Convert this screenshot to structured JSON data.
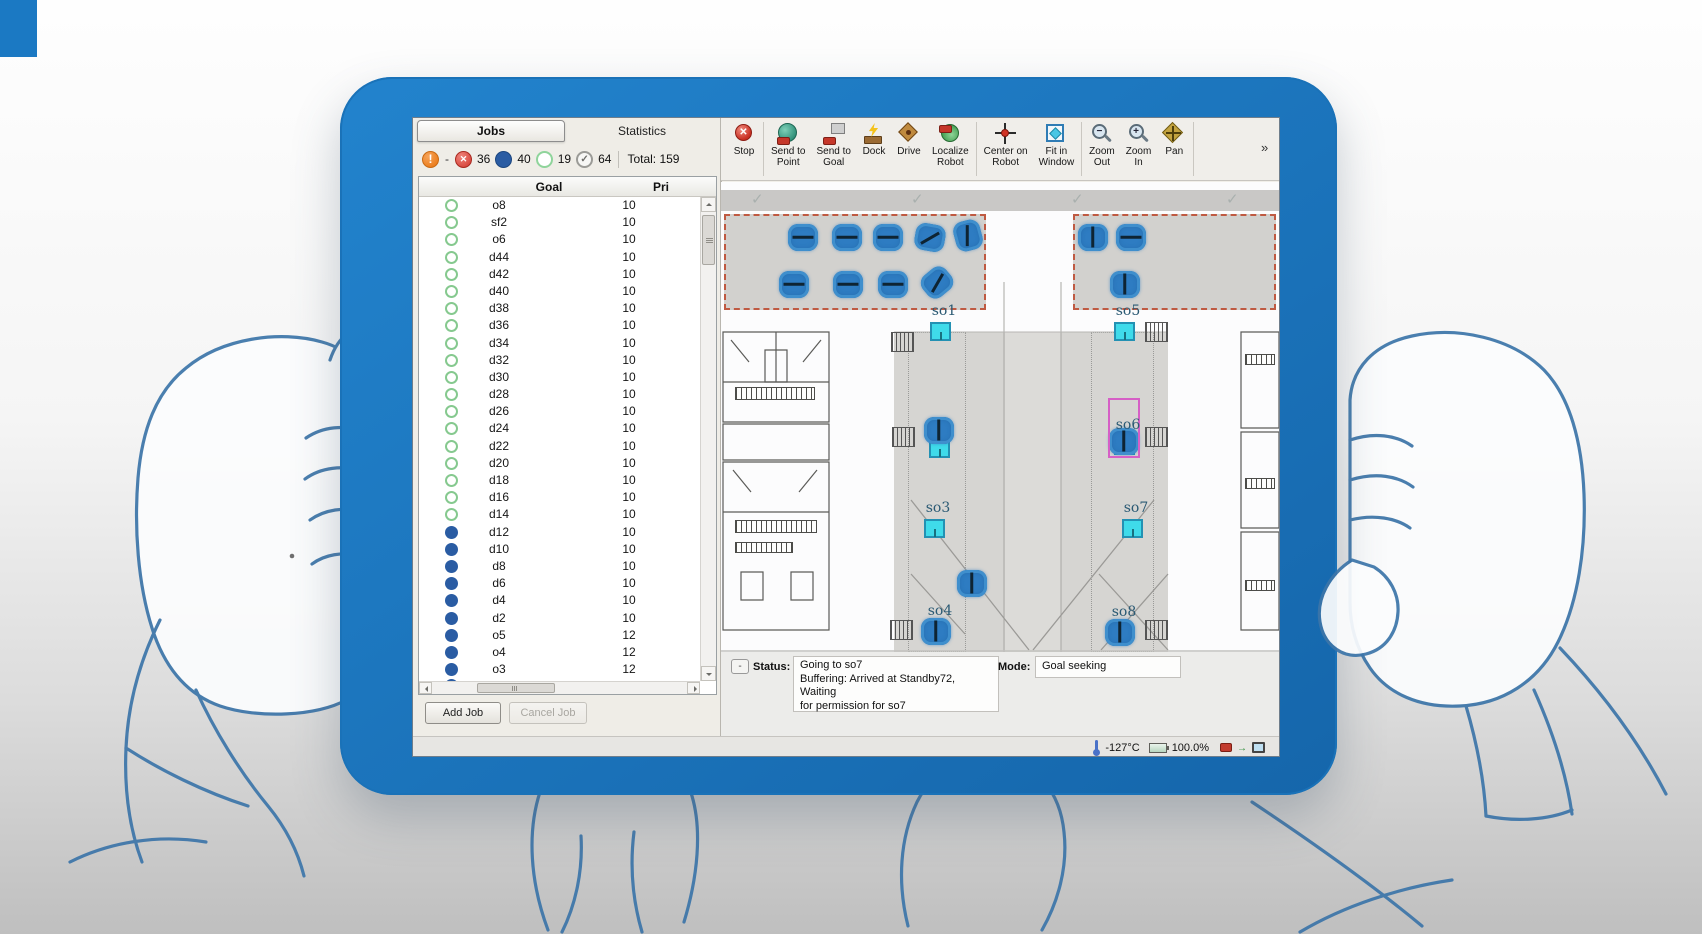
{
  "jobs_panel": {
    "tabs": {
      "jobs": "Jobs",
      "statistics": "Statistics"
    },
    "counters": {
      "overflow_dash": "-",
      "failed": "36",
      "in_progress": "40",
      "queued": "19",
      "completed": "64",
      "total": "Total: 159",
      "colors": {
        "failed": "#d84a40",
        "in_progress": "#2a5ca3",
        "queued": "#8fd49b",
        "completed": "#9b9b97",
        "warning": "#ec7f1f"
      }
    },
    "table": {
      "columns": {
        "goal": "Goal",
        "priority": "Pri"
      },
      "rows": [
        {
          "goal": "o8",
          "pri": "10",
          "state": "queued"
        },
        {
          "goal": "sf2",
          "pri": "10",
          "state": "queued"
        },
        {
          "goal": "o6",
          "pri": "10",
          "state": "queued"
        },
        {
          "goal": "d44",
          "pri": "10",
          "state": "queued"
        },
        {
          "goal": "d42",
          "pri": "10",
          "state": "queued"
        },
        {
          "goal": "d40",
          "pri": "10",
          "state": "queued"
        },
        {
          "goal": "d38",
          "pri": "10",
          "state": "queued"
        },
        {
          "goal": "d36",
          "pri": "10",
          "state": "queued"
        },
        {
          "goal": "d34",
          "pri": "10",
          "state": "queued"
        },
        {
          "goal": "d32",
          "pri": "10",
          "state": "queued"
        },
        {
          "goal": "d30",
          "pri": "10",
          "state": "queued"
        },
        {
          "goal": "d28",
          "pri": "10",
          "state": "queued"
        },
        {
          "goal": "d26",
          "pri": "10",
          "state": "queued"
        },
        {
          "goal": "d24",
          "pri": "10",
          "state": "queued"
        },
        {
          "goal": "d22",
          "pri": "10",
          "state": "queued"
        },
        {
          "goal": "d20",
          "pri": "10",
          "state": "queued"
        },
        {
          "goal": "d18",
          "pri": "10",
          "state": "queued"
        },
        {
          "goal": "d16",
          "pri": "10",
          "state": "queued"
        },
        {
          "goal": "d14",
          "pri": "10",
          "state": "queued"
        },
        {
          "goal": "d12",
          "pri": "10",
          "state": "active"
        },
        {
          "goal": "d10",
          "pri": "10",
          "state": "active"
        },
        {
          "goal": "d8",
          "pri": "10",
          "state": "active"
        },
        {
          "goal": "d6",
          "pri": "10",
          "state": "active"
        },
        {
          "goal": "d4",
          "pri": "10",
          "state": "active"
        },
        {
          "goal": "d2",
          "pri": "10",
          "state": "active"
        },
        {
          "goal": "o5",
          "pri": "12",
          "state": "active"
        },
        {
          "goal": "o4",
          "pri": "12",
          "state": "active"
        },
        {
          "goal": "o3",
          "pri": "12",
          "state": "active"
        }
      ]
    },
    "actions": {
      "add_job": "Add Job",
      "cancel_job": "Cancel Job"
    }
  },
  "toolbar": {
    "buttons": [
      {
        "icon": "stop-icon",
        "label_lines": [
          "Stop"
        ],
        "sep_after": true
      },
      {
        "icon": "send-to-point-icon",
        "label_lines": [
          "Send to",
          "Point"
        ],
        "sep_after": false
      },
      {
        "icon": "send-to-goal-icon",
        "label_lines": [
          "Send to",
          "Goal"
        ],
        "sep_after": false
      },
      {
        "icon": "dock-icon",
        "label_lines": [
          "Dock"
        ],
        "sep_after": false
      },
      {
        "icon": "drive-icon",
        "label_lines": [
          "Drive"
        ],
        "sep_after": false
      },
      {
        "icon": "localize-robot-icon",
        "label_lines": [
          "Localize",
          "Robot"
        ],
        "sep_after": true
      },
      {
        "icon": "center-on-robot-icon",
        "label_lines": [
          "Center on",
          "Robot"
        ],
        "sep_after": false
      },
      {
        "icon": "fit-in-window-icon",
        "label_lines": [
          "Fit in",
          "Window"
        ],
        "sep_after": true
      },
      {
        "icon": "zoom-out-icon",
        "label_lines": [
          "Zoom",
          "Out"
        ],
        "sep_after": false
      },
      {
        "icon": "zoom-in-icon",
        "label_lines": [
          "Zoom",
          "In"
        ],
        "sep_after": false
      },
      {
        "icon": "pan-icon",
        "label_lines": [
          "Pan"
        ],
        "sep_after": true
      }
    ],
    "overflow": "»"
  },
  "map": {
    "goal_color": "#3fdbea",
    "robot_color": "#2e7cc2",
    "goals": [
      {
        "label": "so1",
        "x": 219,
        "y": 149
      },
      {
        "label": "so5",
        "x": 403,
        "y": 149
      },
      {
        "label": "",
        "x": 218,
        "y": 266
      },
      {
        "label": "so6",
        "x": 403,
        "y": 263,
        "highlight": true
      },
      {
        "label": "so3",
        "x": 213,
        "y": 346
      },
      {
        "label": "so7",
        "x": 411,
        "y": 346
      },
      {
        "label": "so4",
        "x": 215,
        "y": 449
      },
      {
        "label": "so8",
        "x": 399,
        "y": 450
      }
    ],
    "robots": [
      {
        "x": 82,
        "y": 55,
        "body": 0,
        "line": 0
      },
      {
        "x": 126,
        "y": 55,
        "body": 0,
        "line": 0
      },
      {
        "x": 167,
        "y": 55,
        "body": 0,
        "line": 0
      },
      {
        "x": 209,
        "y": 55,
        "body": 10,
        "line": -30
      },
      {
        "x": 247,
        "y": 53,
        "body": 75,
        "line": 90
      },
      {
        "x": 73,
        "y": 102,
        "body": 0,
        "line": 0
      },
      {
        "x": 127,
        "y": 102,
        "body": 0,
        "line": 0
      },
      {
        "x": 172,
        "y": 102,
        "body": 0,
        "line": 0
      },
      {
        "x": 216,
        "y": 100,
        "body": -40,
        "line": -60
      },
      {
        "x": 372,
        "y": 55,
        "body": 0,
        "line": 90
      },
      {
        "x": 410,
        "y": 55,
        "body": 0,
        "line": 0
      },
      {
        "x": 404,
        "y": 102,
        "body": 0,
        "line": 90
      },
      {
        "x": 218,
        "y": 248,
        "body": 0,
        "line": 90
      },
      {
        "x": 403,
        "y": 259,
        "body": 0,
        "line": 90
      },
      {
        "x": 251,
        "y": 401,
        "body": 0,
        "line": 90
      },
      {
        "x": 215,
        "y": 449,
        "body": 0,
        "line": 90
      },
      {
        "x": 399,
        "y": 450,
        "body": 0,
        "line": 90
      }
    ]
  },
  "status_panel": {
    "collapse": "-",
    "status_label": "Status:",
    "status_lines": [
      "Going to so7",
      "Buffering: Arrived at Standby72, Waiting",
      "for permission for so7"
    ],
    "mode_label": "Mode:",
    "mode_value": "Goal seeking"
  },
  "footer": {
    "temperature": "-127°C",
    "battery": "100.0%"
  }
}
